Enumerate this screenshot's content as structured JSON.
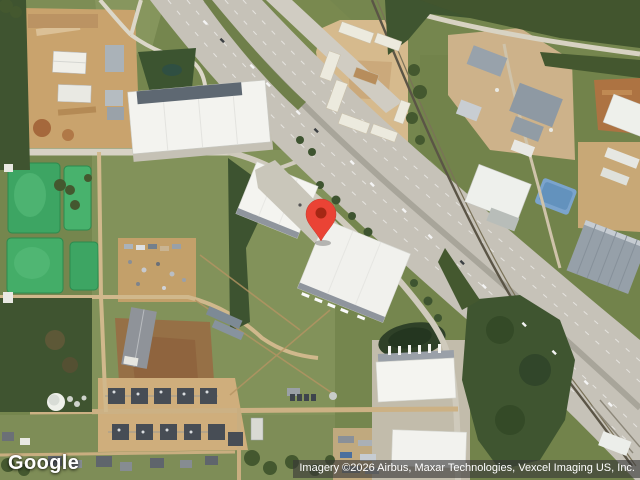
{
  "page": {
    "width_px": 640,
    "height_px": 480,
    "view": "satellite-imagery"
  },
  "branding": {
    "logo_text": "Google"
  },
  "attribution": {
    "text": "Imagery ©2026 Airbus, Maxar Technologies, Vexcel Imaging US, Inc."
  },
  "marker": {
    "label": "location-pin",
    "fill": "#ea4335",
    "dot_fill": "#a52714"
  },
  "palette": {
    "grass": "#75864e",
    "forest": "#3f5530",
    "dirt": "#c9a36d",
    "pavement": "#c6c2b8",
    "roof_white": "#f2f2ee",
    "roof_gray": "#96a0a9",
    "pond_green": "#3da563",
    "pond_blue": "#7ba4cd"
  }
}
